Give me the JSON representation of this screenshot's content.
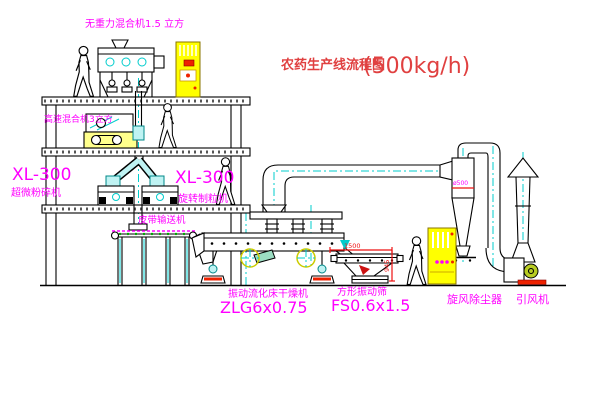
{
  "title": {
    "main": "农药生产线流程图",
    "capacity": "(500kg/h)"
  },
  "building": {
    "gravity_mixer_label": "无重力混合机1.5 立方",
    "high_speed_mixer_label": "高速混合机3立方",
    "pulverizer": {
      "model": "XL-300",
      "name": "超微粉碎机"
    },
    "granulator": {
      "model": "XL-300",
      "name": "旋转制粒机"
    },
    "belt_conveyor_label": "皮带输送机"
  },
  "equipment": {
    "dryer": {
      "name": "振动流化床干燥机",
      "model": "ZLG6x0.75"
    },
    "sieve": {
      "name": "方形振动筛",
      "model": "FS0.6x1.5",
      "dim_length": "1500",
      "dim_height": "945"
    },
    "cyclone": {
      "name": "旋风除尘器",
      "note": "ø500"
    },
    "fan": {
      "name": "引风机"
    }
  },
  "colors": {
    "title_red": "#e04040",
    "label_magenta": "#ff00ff",
    "dimension_red": "#ee1111",
    "accent_cyan": "#00cccc",
    "cabinet_yellow": "#ffff00",
    "line_black": "#000000"
  }
}
